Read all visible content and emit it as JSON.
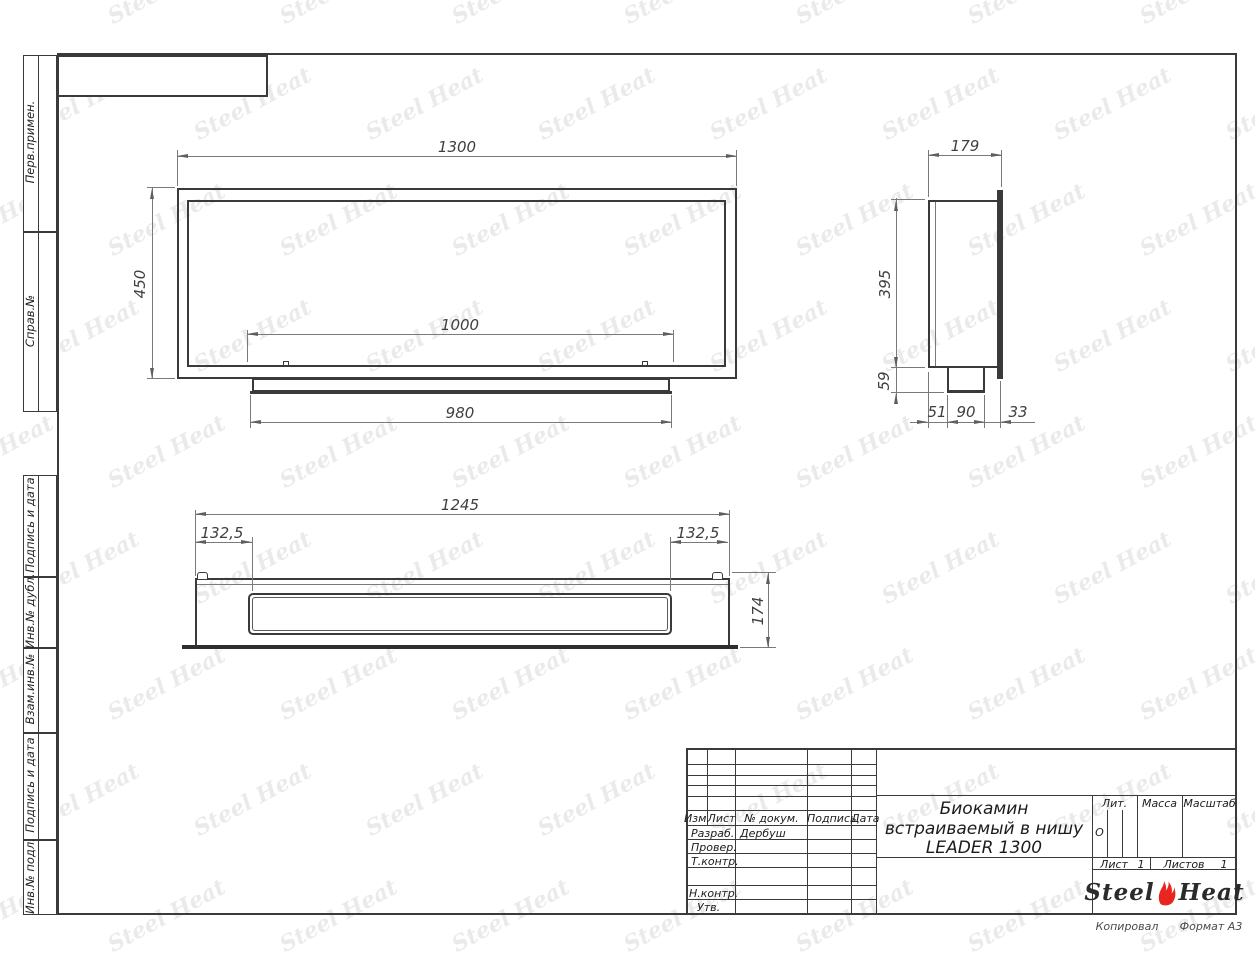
{
  "page": {
    "watermark": "Steel Heat",
    "copy_label": "Копировал",
    "format_label": "Формат А3",
    "line_color": "#3a3a3a",
    "flame_color": "#e8261f"
  },
  "side_labels": [
    "Перв.примен.",
    "Справ.№",
    "Подпись и дата",
    "Инв.№ дубл.",
    "Взам.инв.№",
    "Подпись и дата",
    "Инв.№ подл."
  ],
  "title_block": {
    "header_cols": [
      "Изм.",
      "Лист",
      "№ докум.",
      "Подпись",
      "Дата"
    ],
    "rows": [
      {
        "label": "Разраб.",
        "value": "Дербуш"
      },
      {
        "label": "Провер.",
        "value": ""
      },
      {
        "label": "Т.контр.",
        "value": ""
      },
      {
        "label": "",
        "value": ""
      },
      {
        "label": "Н.контр.",
        "value": ""
      },
      {
        "label": "Утв.",
        "value": ""
      }
    ],
    "title_lines": [
      "Биокамин",
      "встраиваемый в нишу",
      "LEADER 1300"
    ],
    "lit_label": "Лит.",
    "lit_value": "О",
    "mass_label": "Масса",
    "scale_label": "Масштаб",
    "sheet_label": "Лист",
    "sheet_value": "1",
    "sheets_label": "Листов",
    "sheets_value": "1",
    "logo": {
      "steel": "Steel",
      "heat": "Heat"
    }
  },
  "views": {
    "front": {
      "dims": {
        "width": "1300",
        "height": "450",
        "opening": "1000",
        "base": "980"
      }
    },
    "side": {
      "dims": {
        "depth": "179",
        "height": "395",
        "bottom": "59",
        "seg1": "51",
        "seg2": "90",
        "seg3": "33"
      }
    },
    "top": {
      "dims": {
        "width": "1245",
        "inset_left": "132,5",
        "inset_right": "132,5",
        "depth": "174"
      }
    }
  }
}
